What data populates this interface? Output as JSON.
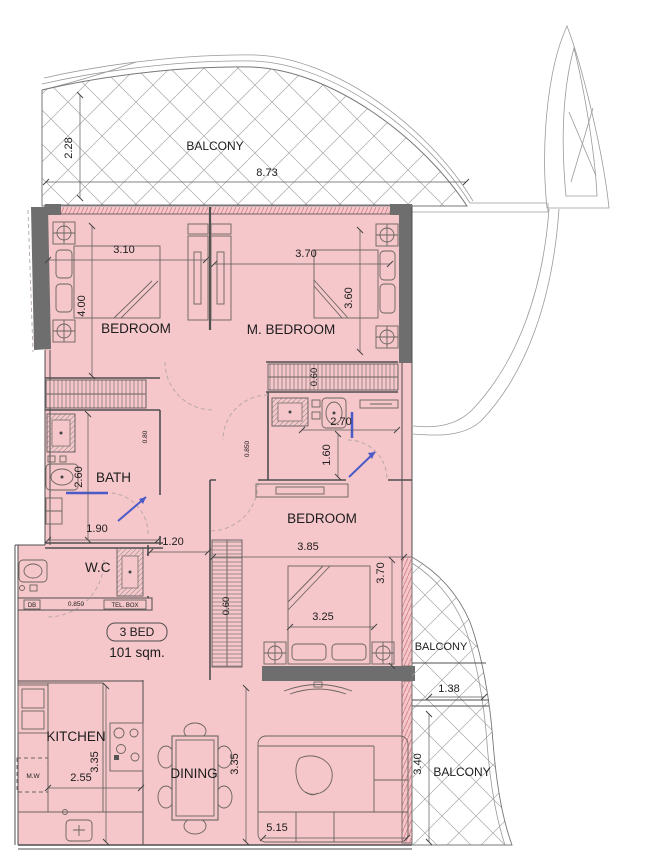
{
  "unit": {
    "badge": "3 BED",
    "area": "101 sqm."
  },
  "rooms": {
    "balcony_top": {
      "label": "BALCONY",
      "dim_depth": "2.28",
      "dim_width": "8.73"
    },
    "bedroom_1": {
      "label": "BEDROOM",
      "dim_width": "3.10",
      "dim_depth": "4.00"
    },
    "master_bedroom": {
      "label": "M. BEDROOM",
      "dim_width": "3.70",
      "dim_depth": "3.60",
      "dim_wardrobe": "0.60"
    },
    "bath": {
      "label": "BATH",
      "dim_depth": "2.60",
      "dim_width": "1.90",
      "dim_door": "0.80"
    },
    "ensuite_bath": {
      "dim_width": "2.70",
      "dim_depth": "1.60",
      "dim_door": "0.850"
    },
    "hallway": {
      "dim_width": "1.20",
      "dim_door": "0.850",
      "db_label": "DB",
      "tel_label": "TEL. BOX"
    },
    "wc": {
      "label": "W.C"
    },
    "bedroom_3": {
      "label": "BEDROOM",
      "dim_width": "3.85",
      "dim_depth": "3.70",
      "dim_bed": "3.25",
      "dim_wardrobe": "0.60"
    },
    "kitchen": {
      "label": "KITCHEN",
      "dim_width": "2.55",
      "dim_depth": "3.35",
      "microwave": "M.W"
    },
    "dining": {
      "label": "DINING"
    },
    "living": {
      "dim_depth": "3.35",
      "dim_width": "5.15"
    },
    "balcony_right_upper": {
      "label": "BALCONY",
      "dim_width": "1.38"
    },
    "balcony_right_lower": {
      "label": "BALCONY",
      "dim_depth": "3.40"
    }
  },
  "colors": {
    "room_fill": "#f5c6ca",
    "wall_dark": "#6e6e6e",
    "glass_blue": "#4a5bc8",
    "line": "#4f4f4f"
  }
}
